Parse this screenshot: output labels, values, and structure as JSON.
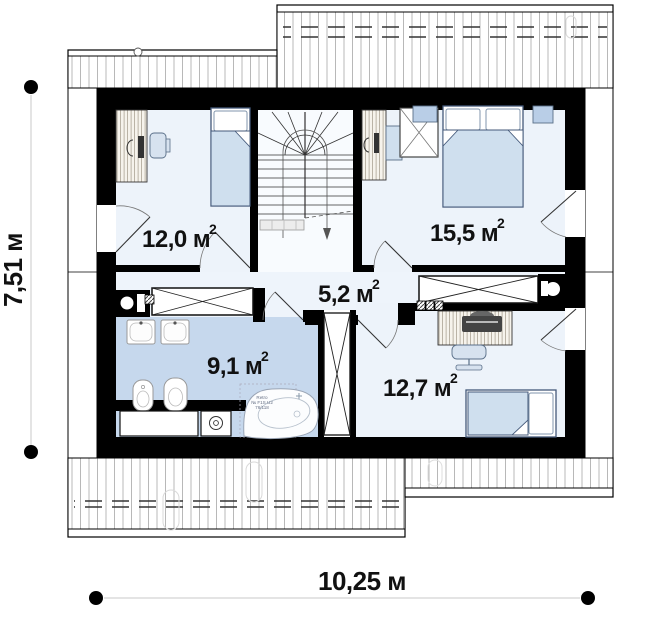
{
  "plan": {
    "type": "floor-plan",
    "rooms": [
      {
        "id": "bedroom-left",
        "label": "12,0 м",
        "exp": "2"
      },
      {
        "id": "bedroom-right",
        "label": "15,5 м",
        "exp": "2"
      },
      {
        "id": "hallway",
        "label": "5,2 м",
        "exp": "2"
      },
      {
        "id": "bathroom",
        "label": "9,1 м",
        "exp": "2"
      },
      {
        "id": "bedroom-bottom",
        "label": "12,7 м",
        "exp": "2"
      }
    ],
    "dimensions": {
      "height_label": "7,51 м",
      "width_label": "10,25 м"
    },
    "bathtub_label": {
      "line1": "Retro",
      "line2": "№ F1S U2",
      "line3": "76/118"
    },
    "colors": {
      "wall": "#000000",
      "room_floor": "#edf3fa",
      "bathroom_floor": "#c6d8ed",
      "furniture_fill": "#cfdfee",
      "furniture_stroke": "#44597a",
      "roof_hatch": "#b8b8b8",
      "dimension_marker": "#000000"
    }
  }
}
